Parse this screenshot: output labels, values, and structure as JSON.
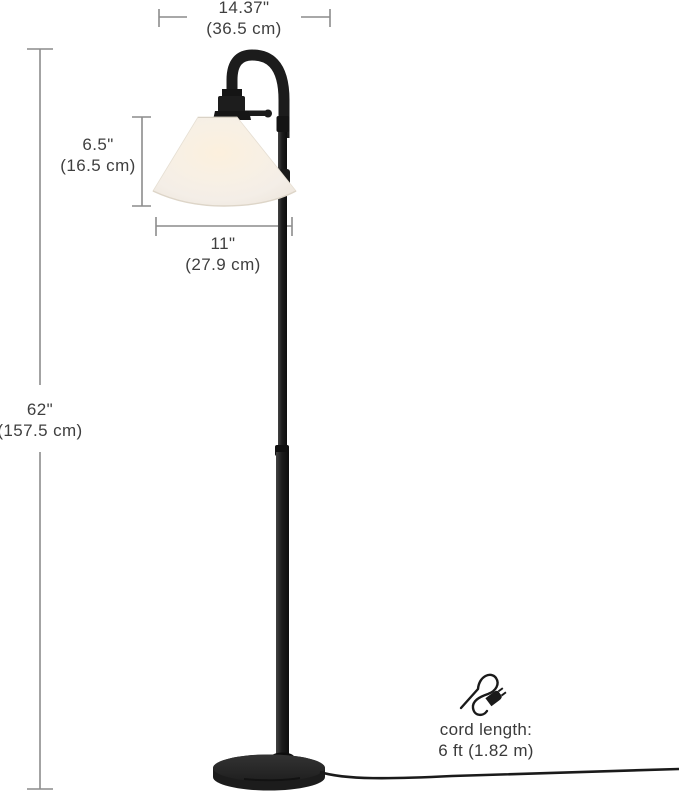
{
  "canvas": {
    "width": 679,
    "height": 793,
    "background": "#ffffff"
  },
  "dimensions": {
    "shade_top_width": {
      "inches": "14.37\"",
      "metric": "(36.5 cm)"
    },
    "shade_height": {
      "inches": "6.5\"",
      "metric": "(16.5 cm)"
    },
    "shade_bottom_width": {
      "inches": "11\"",
      "metric": "(27.9 cm)"
    },
    "lamp_height": {
      "inches": "62\"",
      "metric": "(157.5 cm)"
    }
  },
  "cord": {
    "label": "cord length:",
    "value": "6 ft (1.82 m)",
    "icon": "power-cord-plug-icon"
  },
  "colors": {
    "lamp_body": "#1c1c1c",
    "base": "#242424",
    "shade": "#f4eee7",
    "shade_glow": "#fcf0dd",
    "dimension_line": "#8c8c8c",
    "text": "#3f3f3f",
    "background": "#ffffff"
  }
}
